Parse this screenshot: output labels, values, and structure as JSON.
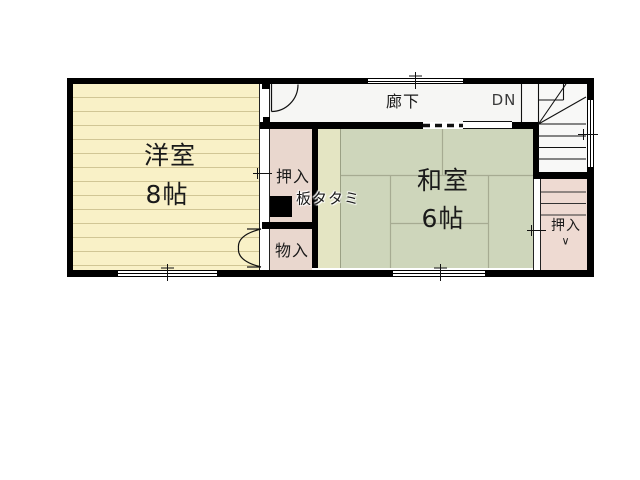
{
  "floorplan": {
    "western_room": {
      "name": "洋室",
      "size": "8帖"
    },
    "japanese_room": {
      "name": "和室",
      "size": "6帖"
    },
    "corridor": {
      "name": "廊下"
    },
    "stairs": {
      "direction_label": "DN"
    },
    "closet_upper": {
      "name": "押入"
    },
    "board_tatami": {
      "name": "板タタミ"
    },
    "storage": {
      "name": "物入"
    },
    "closet_under_stairs": {
      "name": "押入",
      "arrow": "∨"
    },
    "colors": {
      "wall": "#000000",
      "western_room_fill": "#f9f1c7",
      "japanese_room_fill": "#ced6bb",
      "board_tatami_fill": "#e4e5c3",
      "closet_fill": "#e9d7ce",
      "under_stair_closet_fill": "#eedad2",
      "corridor_fill": "#f6f6f4",
      "stairs_fill": "#f8f8f7"
    }
  }
}
